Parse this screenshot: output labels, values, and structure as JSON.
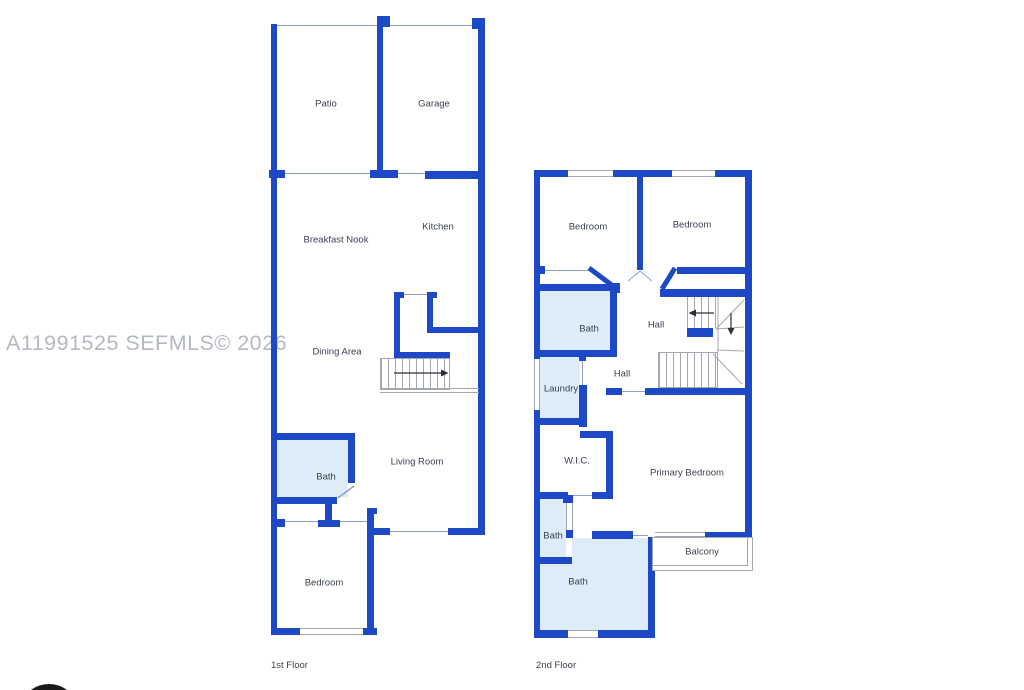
{
  "watermark": "A11991525 SEFMLS© 2026",
  "colors": {
    "wall": "#1d49c6",
    "room_fill": "#ddecf8",
    "thin_line": "#8f9fc8",
    "stair_line": "#a3a8b0",
    "label_text": "#39414f",
    "title_text": "#3a3f4a",
    "watermark_text": "#b4b8c0",
    "logo": "#1a1a1d"
  },
  "floor1": {
    "title": "1st Floor",
    "rooms": {
      "patio": "Patio",
      "garage": "Garage",
      "kitchen": "Kitchen",
      "breakfast_nook": "Breakfast Nook",
      "dining_area": "Dining Area",
      "living_room": "Living Room",
      "bath": "Bath",
      "bedroom": "Bedroom"
    }
  },
  "floor2": {
    "title": "2nd Floor",
    "rooms": {
      "bedroom_left": "Bedroom",
      "bedroom_right": "Bedroom",
      "bath_upper": "Bath",
      "hall_upper": "Hall",
      "laundry": "Laundry",
      "hall_lower": "Hall",
      "wic": "W.I.C.",
      "primary_bedroom": "Primary Bedroom",
      "bath_small": "Bath",
      "bath_main": "Bath",
      "balcony": "Balcony"
    }
  }
}
